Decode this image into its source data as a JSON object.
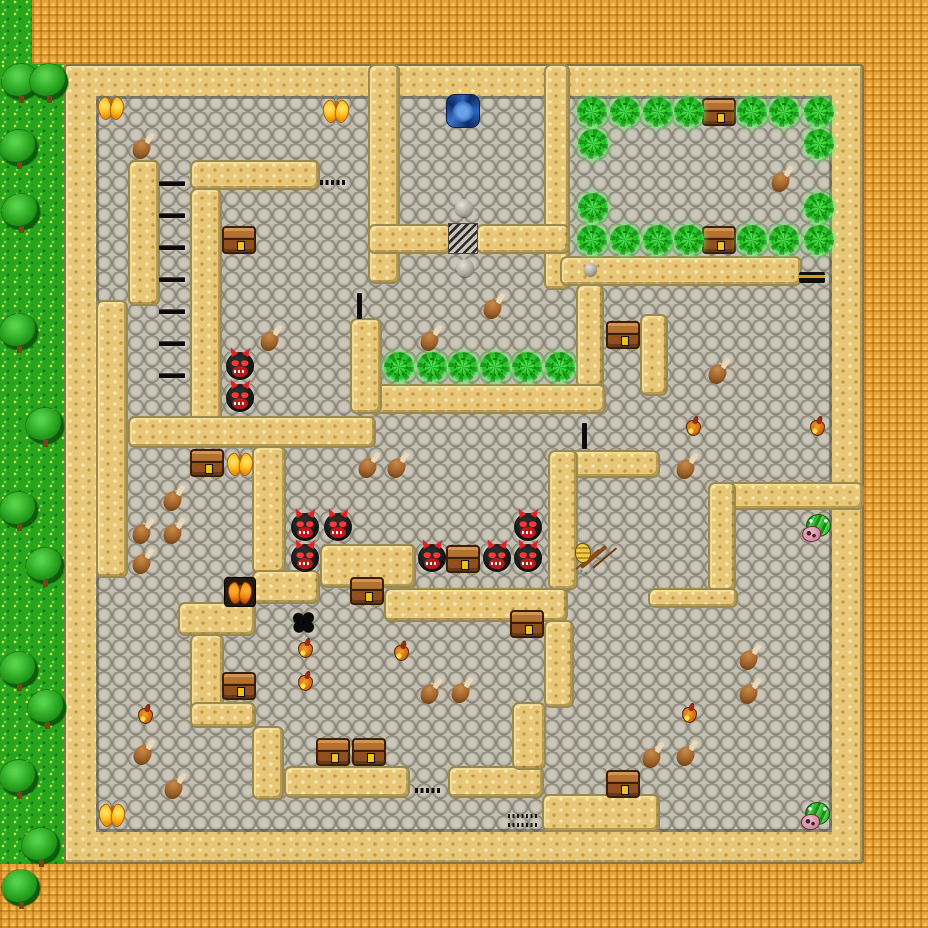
{
  "title": "dungeon-maze-level",
  "palette": {
    "orange": "#E8A437",
    "grass": "#27A51C",
    "sand": "#E8C878",
    "stone": "#9D998E",
    "sand-edge": "#9A8A50",
    "dark": "#0C0C0C"
  },
  "viewport": {
    "width": 928,
    "height": 928,
    "tile": 32
  },
  "terrain": {
    "background": {
      "name": "desert-ground"
    },
    "grass_patches": [
      {
        "name": "grass-strip-top",
        "x": 0,
        "y": 0,
        "w": 32,
        "h": 64
      },
      {
        "name": "grass-strip-left",
        "x": 0,
        "y": 64,
        "w": 64,
        "h": 800
      }
    ],
    "wall_ring": {
      "name": "dungeon-outer-wall",
      "x": 64,
      "y": 64,
      "w": 800,
      "h": 800
    },
    "floor": {
      "name": "stone-floor",
      "x": 96,
      "y": 96,
      "w": 736,
      "h": 736
    },
    "walls": [
      {
        "name": "top-room-left-wall",
        "x": 368,
        "y": 64,
        "w": 32,
        "h": 220
      },
      {
        "name": "top-room-right-wall",
        "x": 544,
        "y": 64,
        "w": 26,
        "h": 226
      },
      {
        "name": "grate-wall-left",
        "x": 368,
        "y": 224,
        "w": 84,
        "h": 30
      },
      {
        "name": "grate-wall-right",
        "x": 476,
        "y": 224,
        "w": 94,
        "h": 30
      },
      {
        "name": "ne-room-south-wall",
        "x": 560,
        "y": 256,
        "w": 242,
        "h": 30
      },
      {
        "name": "ne-col18-wall",
        "x": 576,
        "y": 284,
        "w": 28,
        "h": 104
      },
      {
        "name": "center-row12-wall",
        "x": 362,
        "y": 384,
        "w": 244,
        "h": 30
      },
      {
        "name": "center-col11-wall",
        "x": 350,
        "y": 318,
        "w": 32,
        "h": 96
      },
      {
        "name": "ne-stub-wall",
        "x": 640,
        "y": 314,
        "w": 28,
        "h": 82
      },
      {
        "name": "nw-row5-wall",
        "x": 190,
        "y": 160,
        "w": 130,
        "h": 30
      },
      {
        "name": "nw-col4-wall",
        "x": 128,
        "y": 160,
        "w": 32,
        "h": 146
      },
      {
        "name": "west-col3-wall",
        "x": 96,
        "y": 300,
        "w": 32,
        "h": 278
      },
      {
        "name": "nw-col6-wall",
        "x": 190,
        "y": 188,
        "w": 32,
        "h": 260
      },
      {
        "name": "west-row13-wall",
        "x": 128,
        "y": 416,
        "w": 248,
        "h": 32
      },
      {
        "name": "mid-col8-wall",
        "x": 252,
        "y": 446,
        "w": 34,
        "h": 128
      },
      {
        "name": "stair-step2-wall",
        "x": 252,
        "y": 570,
        "w": 68,
        "h": 34
      },
      {
        "name": "stair-step1-wall",
        "x": 320,
        "y": 544,
        "w": 96,
        "h": 44
      },
      {
        "name": "stair-row18-wall",
        "x": 384,
        "y": 588,
        "w": 184,
        "h": 34
      },
      {
        "name": "stair-step3-wall",
        "x": 178,
        "y": 602,
        "w": 78,
        "h": 34
      },
      {
        "name": "sw-col6-wall",
        "x": 190,
        "y": 634,
        "w": 34,
        "h": 94
      },
      {
        "name": "sw-row22-wall",
        "x": 190,
        "y": 702,
        "w": 66,
        "h": 26
      },
      {
        "name": "sw-col8-wall",
        "x": 252,
        "y": 726,
        "w": 32,
        "h": 74
      },
      {
        "name": "south-row24-west-wall",
        "x": 284,
        "y": 766,
        "w": 126,
        "h": 32
      },
      {
        "name": "south-row24-east-wall",
        "x": 448,
        "y": 766,
        "w": 96,
        "h": 32
      },
      {
        "name": "east-row14-wall",
        "x": 548,
        "y": 450,
        "w": 112,
        "h": 28
      },
      {
        "name": "east-col17-wall",
        "x": 548,
        "y": 450,
        "w": 30,
        "h": 140
      },
      {
        "name": "south-col17-wall",
        "x": 544,
        "y": 620,
        "w": 30,
        "h": 88
      },
      {
        "name": "south-col16-wall",
        "x": 512,
        "y": 702,
        "w": 34,
        "h": 68
      },
      {
        "name": "south-block-wall",
        "x": 542,
        "y": 794,
        "w": 118,
        "h": 38
      },
      {
        "name": "se-row15-wall",
        "x": 708,
        "y": 482,
        "w": 156,
        "h": 28
      },
      {
        "name": "se-col22-wall",
        "x": 708,
        "y": 482,
        "w": 28,
        "h": 110
      },
      {
        "name": "se-row18-wall",
        "x": 648,
        "y": 588,
        "w": 90,
        "h": 20
      }
    ]
  },
  "doors": [
    {
      "kind": "door-dashes",
      "x": 320,
      "y": 180,
      "w": 26,
      "h": 5
    },
    {
      "kind": "door-grate",
      "x": 448,
      "y": 223,
      "w": 30,
      "h": 31
    },
    {
      "kind": "door-tick",
      "x": 357,
      "y": 293,
      "w": 5,
      "h": 26
    },
    {
      "kind": "door-tick",
      "x": 582,
      "y": 423,
      "w": 5,
      "h": 26
    },
    {
      "kind": "door-gold-bar",
      "x": 799,
      "y": 272,
      "w": 26,
      "h": 11
    },
    {
      "kind": "door-dashes",
      "x": 415,
      "y": 788,
      "w": 26,
      "h": 5
    },
    {
      "kind": "door-dotted-ladder",
      "x": 508,
      "y": 813,
      "w": 30,
      "h": 16
    }
  ],
  "ladder": {
    "x": 159,
    "w": 26,
    "h": 5,
    "rung_ys": [
      181,
      213,
      245,
      277,
      309,
      341,
      373
    ]
  },
  "decor": {
    "pebbles": [
      {
        "x": 455,
        "y": 199,
        "s": 18
      },
      {
        "x": 456,
        "y": 259,
        "s": 18
      },
      {
        "x": 584,
        "y": 263,
        "s": 13
      }
    ],
    "trees": [
      {
        "x": 2,
        "y": 64
      },
      {
        "x": 30,
        "y": 64
      },
      {
        "x": 0,
        "y": 130
      },
      {
        "x": 2,
        "y": 194
      },
      {
        "x": 0,
        "y": 314
      },
      {
        "x": 26,
        "y": 408
      },
      {
        "x": 0,
        "y": 492
      },
      {
        "x": 26,
        "y": 548
      },
      {
        "x": 0,
        "y": 652
      },
      {
        "x": 28,
        "y": 690
      },
      {
        "x": 0,
        "y": 760
      },
      {
        "x": 22,
        "y": 828
      },
      {
        "x": 2,
        "y": 870
      }
    ]
  },
  "entities": [
    {
      "kind": "whirlpool",
      "x": 446,
      "y": 94
    },
    {
      "kind": "chest",
      "x": 702,
      "y": 98
    },
    {
      "kind": "chest",
      "x": 702,
      "y": 226
    },
    {
      "kind": "chest",
      "x": 222,
      "y": 226
    },
    {
      "kind": "chest",
      "x": 606,
      "y": 321
    },
    {
      "kind": "chest",
      "x": 190,
      "y": 449
    },
    {
      "kind": "chest",
      "x": 350,
      "y": 577
    },
    {
      "kind": "chest",
      "x": 446,
      "y": 545
    },
    {
      "kind": "chest",
      "x": 510,
      "y": 610
    },
    {
      "kind": "chest",
      "x": 222,
      "y": 672
    },
    {
      "kind": "chest",
      "x": 316,
      "y": 738
    },
    {
      "kind": "chest",
      "x": 352,
      "y": 738
    },
    {
      "kind": "chest",
      "x": 606,
      "y": 770
    },
    {
      "kind": "butterfly",
      "x": 98,
      "y": 96
    },
    {
      "kind": "butterfly",
      "x": 323,
      "y": 99
    },
    {
      "kind": "butterfly",
      "x": 227,
      "y": 452
    },
    {
      "kind": "butterfly",
      "x": 99,
      "y": 803
    },
    {
      "kind": "moth-box",
      "x": 224,
      "y": 577
    },
    {
      "kind": "slime",
      "x": 577,
      "y": 97
    },
    {
      "kind": "slime",
      "x": 610,
      "y": 97
    },
    {
      "kind": "slime",
      "x": 643,
      "y": 97
    },
    {
      "kind": "slime",
      "x": 674,
      "y": 97
    },
    {
      "kind": "slime",
      "x": 737,
      "y": 97
    },
    {
      "kind": "slime",
      "x": 769,
      "y": 97
    },
    {
      "kind": "slime",
      "x": 804,
      "y": 97
    },
    {
      "kind": "slime",
      "x": 578,
      "y": 129
    },
    {
      "kind": "slime",
      "x": 804,
      "y": 129
    },
    {
      "kind": "slime",
      "x": 578,
      "y": 193
    },
    {
      "kind": "slime",
      "x": 804,
      "y": 193
    },
    {
      "kind": "slime",
      "x": 577,
      "y": 225
    },
    {
      "kind": "slime",
      "x": 610,
      "y": 225
    },
    {
      "kind": "slime",
      "x": 643,
      "y": 225
    },
    {
      "kind": "slime",
      "x": 674,
      "y": 225
    },
    {
      "kind": "slime",
      "x": 737,
      "y": 225
    },
    {
      "kind": "slime",
      "x": 769,
      "y": 225
    },
    {
      "kind": "slime",
      "x": 804,
      "y": 225
    },
    {
      "kind": "slime",
      "x": 384,
      "y": 352
    },
    {
      "kind": "slime",
      "x": 417,
      "y": 352
    },
    {
      "kind": "slime",
      "x": 448,
      "y": 352
    },
    {
      "kind": "slime",
      "x": 480,
      "y": 352
    },
    {
      "kind": "slime",
      "x": 512,
      "y": 352
    },
    {
      "kind": "slime",
      "x": 545,
      "y": 352
    },
    {
      "kind": "devil",
      "x": 226,
      "y": 352
    },
    {
      "kind": "devil",
      "x": 226,
      "y": 384
    },
    {
      "kind": "devil",
      "x": 291,
      "y": 513
    },
    {
      "kind": "devil",
      "x": 324,
      "y": 513
    },
    {
      "kind": "devil",
      "x": 291,
      "y": 544
    },
    {
      "kind": "devil",
      "x": 418,
      "y": 544
    },
    {
      "kind": "devil",
      "x": 483,
      "y": 544
    },
    {
      "kind": "devil",
      "x": 514,
      "y": 544
    },
    {
      "kind": "devil",
      "x": 514,
      "y": 513
    },
    {
      "kind": "chicken-leg",
      "x": 132,
      "y": 131
    },
    {
      "kind": "chicken-leg",
      "x": 260,
      "y": 323
    },
    {
      "kind": "chicken-leg",
      "x": 420,
      "y": 323
    },
    {
      "kind": "chicken-leg",
      "x": 483,
      "y": 291
    },
    {
      "kind": "chicken-leg",
      "x": 771,
      "y": 164
    },
    {
      "kind": "chicken-leg",
      "x": 708,
      "y": 356
    },
    {
      "kind": "chicken-leg",
      "x": 676,
      "y": 451
    },
    {
      "kind": "chicken-leg",
      "x": 358,
      "y": 450
    },
    {
      "kind": "chicken-leg",
      "x": 387,
      "y": 450
    },
    {
      "kind": "chicken-leg",
      "x": 132,
      "y": 516
    },
    {
      "kind": "chicken-leg",
      "x": 163,
      "y": 483
    },
    {
      "kind": "chicken-leg",
      "x": 163,
      "y": 516
    },
    {
      "kind": "chicken-leg",
      "x": 132,
      "y": 546
    },
    {
      "kind": "chicken-leg",
      "x": 133,
      "y": 737
    },
    {
      "kind": "chicken-leg",
      "x": 164,
      "y": 771
    },
    {
      "kind": "chicken-leg",
      "x": 420,
      "y": 676
    },
    {
      "kind": "chicken-leg",
      "x": 451,
      "y": 675
    },
    {
      "kind": "chicken-leg",
      "x": 642,
      "y": 740
    },
    {
      "kind": "chicken-leg",
      "x": 676,
      "y": 738
    },
    {
      "kind": "chicken-leg",
      "x": 739,
      "y": 642
    },
    {
      "kind": "chicken-leg",
      "x": 739,
      "y": 676
    },
    {
      "kind": "flask",
      "x": 686,
      "y": 417
    },
    {
      "kind": "flask",
      "x": 810,
      "y": 417
    },
    {
      "kind": "flask",
      "x": 394,
      "y": 642
    },
    {
      "kind": "flask",
      "x": 298,
      "y": 639
    },
    {
      "kind": "flask",
      "x": 298,
      "y": 672
    },
    {
      "kind": "flask",
      "x": 138,
      "y": 705
    },
    {
      "kind": "flask",
      "x": 682,
      "y": 704
    },
    {
      "kind": "snail",
      "x": 801,
      "y": 512
    },
    {
      "kind": "snail",
      "x": 800,
      "y": 800
    },
    {
      "kind": "beehive",
      "x": 573,
      "y": 540
    },
    {
      "kind": "spider",
      "x": 290,
      "y": 610
    }
  ]
}
